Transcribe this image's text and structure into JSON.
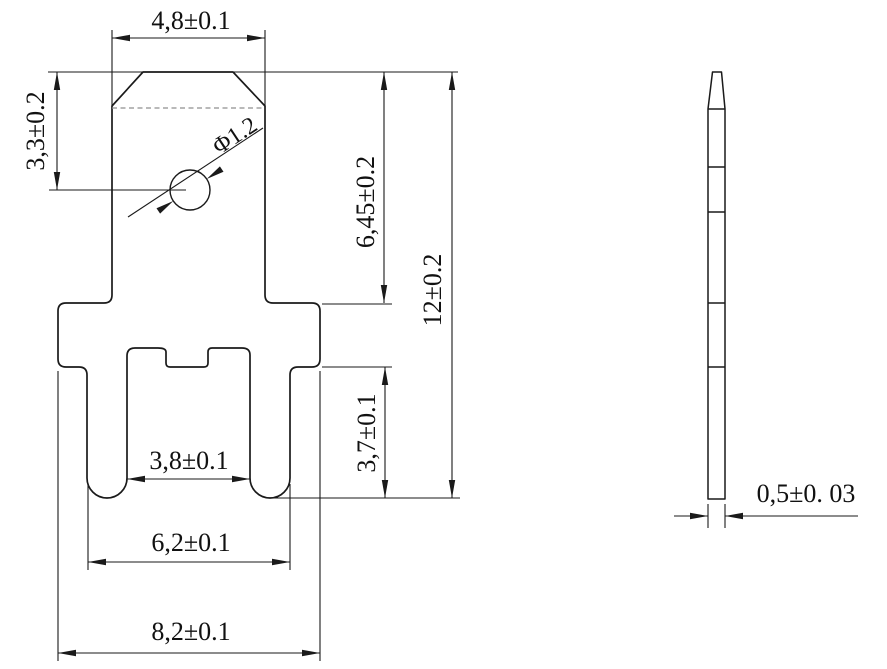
{
  "drawing": {
    "type": "engineering-drawing",
    "part": "pcb-solder-tab-terminal",
    "colors": {
      "background": "#ffffff",
      "line": "#1a1a1a",
      "dashed_line": "#8f8f8f"
    },
    "front_view": {
      "tab_width": "4,8±0.1",
      "hole_offset": "3,3±0.2",
      "hole_diameter": "Φ1.2",
      "tab_length": "6,45±0.2",
      "overall_length": "12±0.2",
      "leg_length": "3,7±0.1",
      "slot_width": "3,8±0.1",
      "leg_span": "6,2±0.1",
      "body_width": "8,2±0.1"
    },
    "side_view": {
      "thickness": "0,5±0. 03"
    }
  }
}
